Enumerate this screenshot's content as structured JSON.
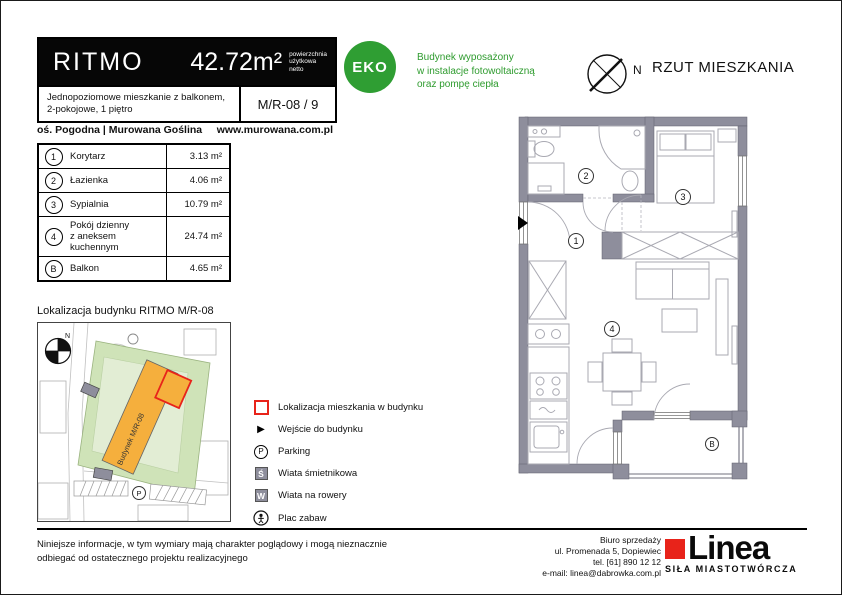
{
  "header": {
    "project_name": "RITMO",
    "area_value": "42.72m²",
    "area_note_line1": "powierzchnia",
    "area_note_line2": "użytkowa",
    "area_note_line3": "netto",
    "description_line1": "Jednopoziomowe mieszkanie z balkonem,",
    "description_line2": "2-pokojowe, 1 piętro",
    "unit_code": "M/R-08 / 9",
    "location": "oś. Pogodna | Murowana Goślina",
    "website": "www.murowana.com.pl"
  },
  "rooms": {
    "items": [
      {
        "no": "1",
        "name": "Korytarz",
        "area": "3.13 m²"
      },
      {
        "no": "2",
        "name": "Łazienka",
        "area": "4.06 m²"
      },
      {
        "no": "3",
        "name": "Sypialnia",
        "area": "10.79 m²"
      },
      {
        "no": "4",
        "name": "Pokój dzienny",
        "name2": "z aneksem kuchennym",
        "area": "24.74 m²"
      },
      {
        "no": "B",
        "name": "Balkon",
        "area": "4.65 m²"
      }
    ]
  },
  "eco": {
    "badge": "EKO",
    "line1": "Budynek wyposażony",
    "line2": "w instalacje fotowoltaiczną",
    "line3": "oraz pompę ciepła"
  },
  "plan": {
    "title": "RZUT MIESZKANIA",
    "compass_label": "N",
    "room_labels": {
      "r1": "1",
      "r2": "2",
      "r3": "3",
      "r4": "4",
      "rb": "B"
    }
  },
  "site_map": {
    "title": "Lokalizacja budynku RITMO M/R-08",
    "building_label": "Budynek M/R-08",
    "parking_label": "P",
    "compass_label": "N"
  },
  "legend": {
    "items": [
      {
        "label": "Lokalizacja mieszkania w budynku"
      },
      {
        "label": "Wejście do budynku"
      },
      {
        "label": "Parking",
        "icon_letter": "P"
      },
      {
        "label": "Wiata śmietnikowa",
        "icon_letter": "Ś"
      },
      {
        "label": "Wiata na rowery",
        "icon_letter": "W"
      },
      {
        "label": "Plac zabaw"
      }
    ]
  },
  "footer": {
    "disclaimer_line1": "Niniejsze informacje, w tym wymiary mają charakter poglądowy i mogą nieznacznie",
    "disclaimer_line2": "odbiegać od ostatecznego projektu realizacyjnego",
    "office_line1": "Biuro sprzedaży",
    "office_line2": "ul. Promenada 5, Dopiewiec",
    "office_line3": "tel. [61] 890 12 12",
    "office_line4": "e-mail: linea@dabrowka.com.pl",
    "logo_name": "Linea",
    "logo_tagline": "SIŁA MIASTOTWÓRCZA"
  },
  "colors": {
    "eco_green": "#2f9e33",
    "wall_gray": "#8e8e9c",
    "building_orange": "#f5af3d",
    "map_green": "#cfe3b8",
    "logo_red": "#e8231a",
    "unit_outline_red": "#e8231a"
  }
}
